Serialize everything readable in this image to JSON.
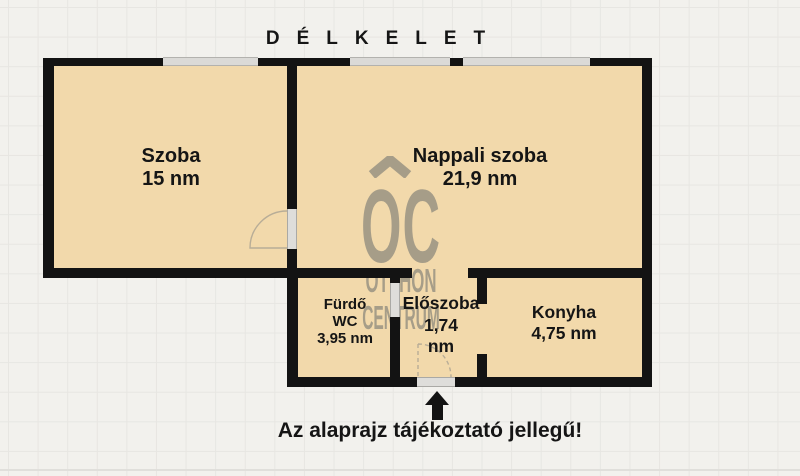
{
  "title": "DÉLKELET",
  "caption": "Az alaprajz tájékoztató jellegű!",
  "watermark": {
    "monogram": "OC",
    "line1": "OTTHON",
    "line2": "CENTRUM"
  },
  "rooms": [
    {
      "id": "szoba",
      "lines": [
        "Szoba",
        "15 nm"
      ]
    },
    {
      "id": "nappali",
      "lines": [
        "Nappali szoba",
        "21,9 nm"
      ]
    },
    {
      "id": "furdo",
      "lines": [
        "Fürdő",
        "WC",
        "3,95 nm"
      ]
    },
    {
      "id": "eloszoba",
      "lines": [
        "Előszoba",
        "1,74",
        "nm"
      ]
    },
    {
      "id": "konyha",
      "lines": [
        "Konyha",
        "4,75 nm"
      ]
    }
  ],
  "icons": {
    "entrance_arrow": "up-arrow",
    "logo_caret": "chevron-roof"
  },
  "colors": {
    "background": "#f2f1ed",
    "grid_line": "#e7e6e2",
    "room_fill": "#f2d9ab",
    "wall": "#131313",
    "window_fill": "#dbdad7",
    "opening_fill": "#deddda",
    "watermark": "#a69d88",
    "text": "#151515",
    "door_arc": "#b8ad97"
  }
}
